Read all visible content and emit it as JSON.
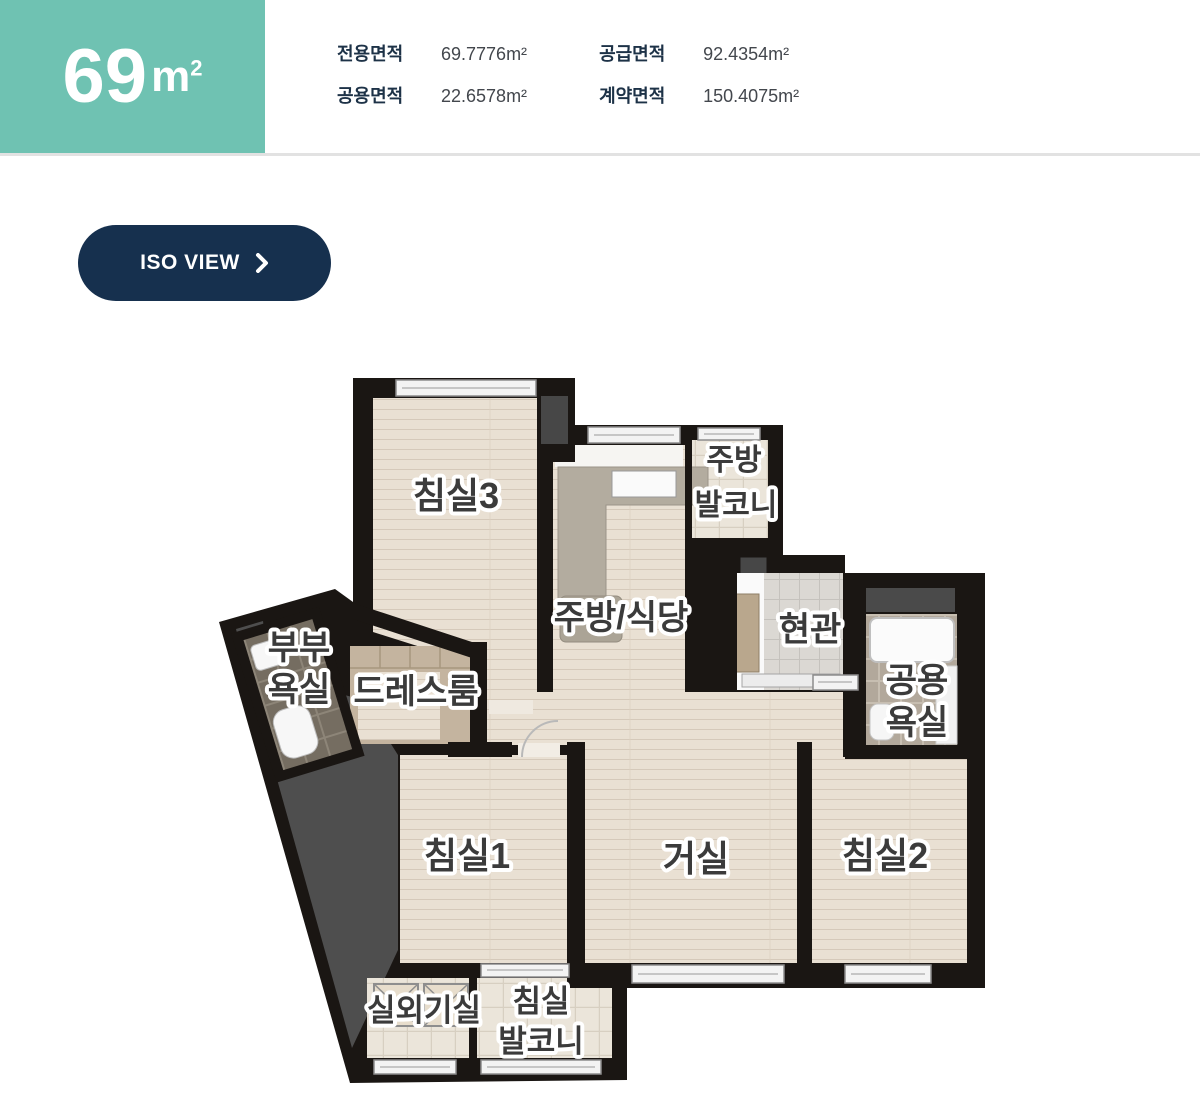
{
  "unit_summary": {
    "size_number": "69",
    "size_unit_base": "m",
    "size_unit_sup": "2"
  },
  "area_table": {
    "rows": [
      {
        "label": "전용면적",
        "value": "69.7776m²"
      },
      {
        "label": "공급면적",
        "value": "92.4354m²"
      },
      {
        "label": "공용면적",
        "value": "22.6578m²"
      },
      {
        "label": "계약면적",
        "value": "150.4075m²"
      }
    ]
  },
  "iso_button": {
    "label": "ISO VIEW"
  },
  "floorplan": {
    "labels": {
      "bedroom3": "침실3",
      "kitchen_balcony_line1": "주방",
      "kitchen_balcony_line2": "발코니",
      "kitchen_dining": "주방/식당",
      "entrance": "현관",
      "master_bath_line1": "부부",
      "master_bath_line2": "욕실",
      "dressroom": "드레스룸",
      "common_bath_line1": "공용",
      "common_bath_line2": "욕실",
      "bedroom1": "침실1",
      "living_room": "거실",
      "bedroom2": "침실2",
      "outdoor_unit_room": "실외기실",
      "bedroom_balcony_line1": "침실",
      "bedroom_balcony_line2": "발코니"
    }
  },
  "colors": {
    "teal_badge": "#6fc2b2",
    "button_navy": "#16304e",
    "table_label_navy": "#1d3247",
    "table_value_gray": "#43474d",
    "wall_black": "#1a1613",
    "wood_floor": "#e9e0d3"
  }
}
